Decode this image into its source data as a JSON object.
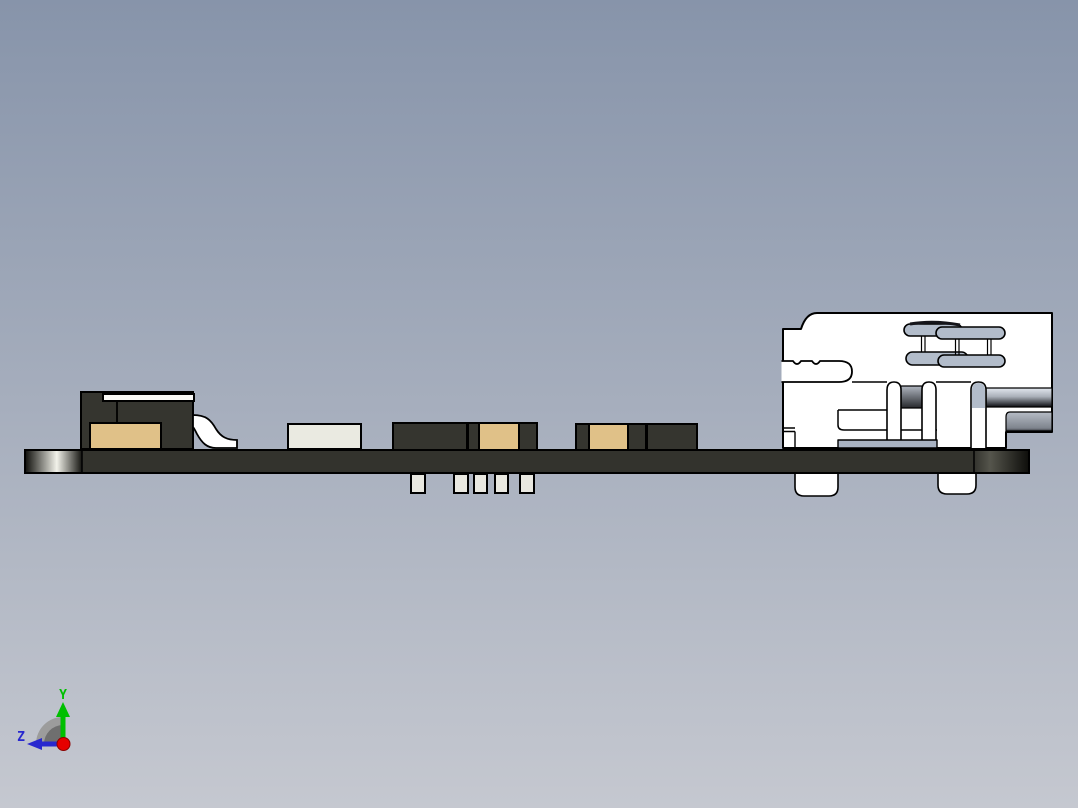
{
  "colors": {
    "bg_top": "#8794aa",
    "bg_bottom": "#c5c8d0",
    "outline": "#000000",
    "pcb": "#33332d",
    "pcb_edge_dark": "#141410",
    "pcb_edge_light": "#f2f2ea",
    "pcb_right_light": "#55554c",
    "pcb_right_dark": "#0f0f0c",
    "comp_dark": "#35352f",
    "comp_tan": "#e0c188",
    "comp_white": "#eaeae1",
    "comp_strip_white": "#fafaf7",
    "pin": "#e9e8e0",
    "connector_white": "#ffffff",
    "metal_blue": "#b2bcca",
    "strip_blue": "#a9b3c3",
    "barrel_light": "#e2e7ee",
    "barrel_mid": "#aab0ba",
    "barrel_dark": "#23252a",
    "band2_light": "#b7bdc7",
    "band2_dark": "#7e848d",
    "hole_light": "#b0b6c0",
    "hole_dark": "#26282c",
    "axis_green": "#00bf00",
    "axis_blue": "#2828cf",
    "axis_red": "#e60000",
    "fan_light": "#9c9c9c",
    "fan_dark": "#6f6f6f"
  },
  "axis_triad": {
    "y_label": "Y",
    "z_label": "Z"
  },
  "scene": {
    "board": {
      "x": 25,
      "y": 450,
      "w": 1004,
      "h": 23
    },
    "components": [
      {
        "name": "ic-body",
        "x": 81,
        "y": 392,
        "w": 112,
        "h": 57,
        "color": "comp_dark"
      },
      {
        "name": "ic-top-strip",
        "x": 103,
        "y": 394,
        "w": 91,
        "h": 7,
        "color": "comp_strip_white"
      },
      {
        "name": "ic-tan-base",
        "x": 90,
        "y": 423,
        "w": 71,
        "h": 26,
        "color": "comp_tan"
      },
      {
        "name": "component-white",
        "x": 288,
        "y": 424,
        "w": 73,
        "h": 25,
        "color": "comp_white"
      },
      {
        "name": "component-dark-1",
        "x": 393,
        "y": 423,
        "w": 74,
        "h": 27,
        "color": "comp_dark"
      },
      {
        "name": "component-2-cap-left",
        "x": 468,
        "y": 423,
        "w": 11,
        "h": 27,
        "color": "comp_dark"
      },
      {
        "name": "component-2-body",
        "x": 479,
        "y": 423,
        "w": 40,
        "h": 27,
        "color": "comp_tan"
      },
      {
        "name": "component-2-cap-right",
        "x": 519,
        "y": 423,
        "w": 18,
        "h": 27,
        "color": "comp_dark"
      },
      {
        "name": "component-3-cap-left",
        "x": 576,
        "y": 424,
        "w": 13,
        "h": 26,
        "color": "comp_dark"
      },
      {
        "name": "component-3-body",
        "x": 589,
        "y": 424,
        "w": 39,
        "h": 26,
        "color": "comp_tan"
      },
      {
        "name": "component-3-cap-right",
        "x": 628,
        "y": 424,
        "w": 18,
        "h": 26,
        "color": "comp_dark"
      },
      {
        "name": "component-dark-2",
        "x": 647,
        "y": 424,
        "w": 50,
        "h": 26,
        "color": "comp_dark"
      },
      {
        "name": "pin-1",
        "x": 411,
        "y": 474,
        "w": 14,
        "h": 19,
        "color": "pin"
      },
      {
        "name": "pin-2",
        "x": 454,
        "y": 474,
        "w": 14,
        "h": 19,
        "color": "pin"
      },
      {
        "name": "pin-3",
        "x": 474,
        "y": 474,
        "w": 13,
        "h": 19,
        "color": "pin"
      },
      {
        "name": "pin-4",
        "x": 495,
        "y": 474,
        "w": 13,
        "h": 19,
        "color": "pin"
      },
      {
        "name": "pin-5",
        "x": 520,
        "y": 474,
        "w": 14,
        "h": 19,
        "color": "pin"
      }
    ]
  }
}
